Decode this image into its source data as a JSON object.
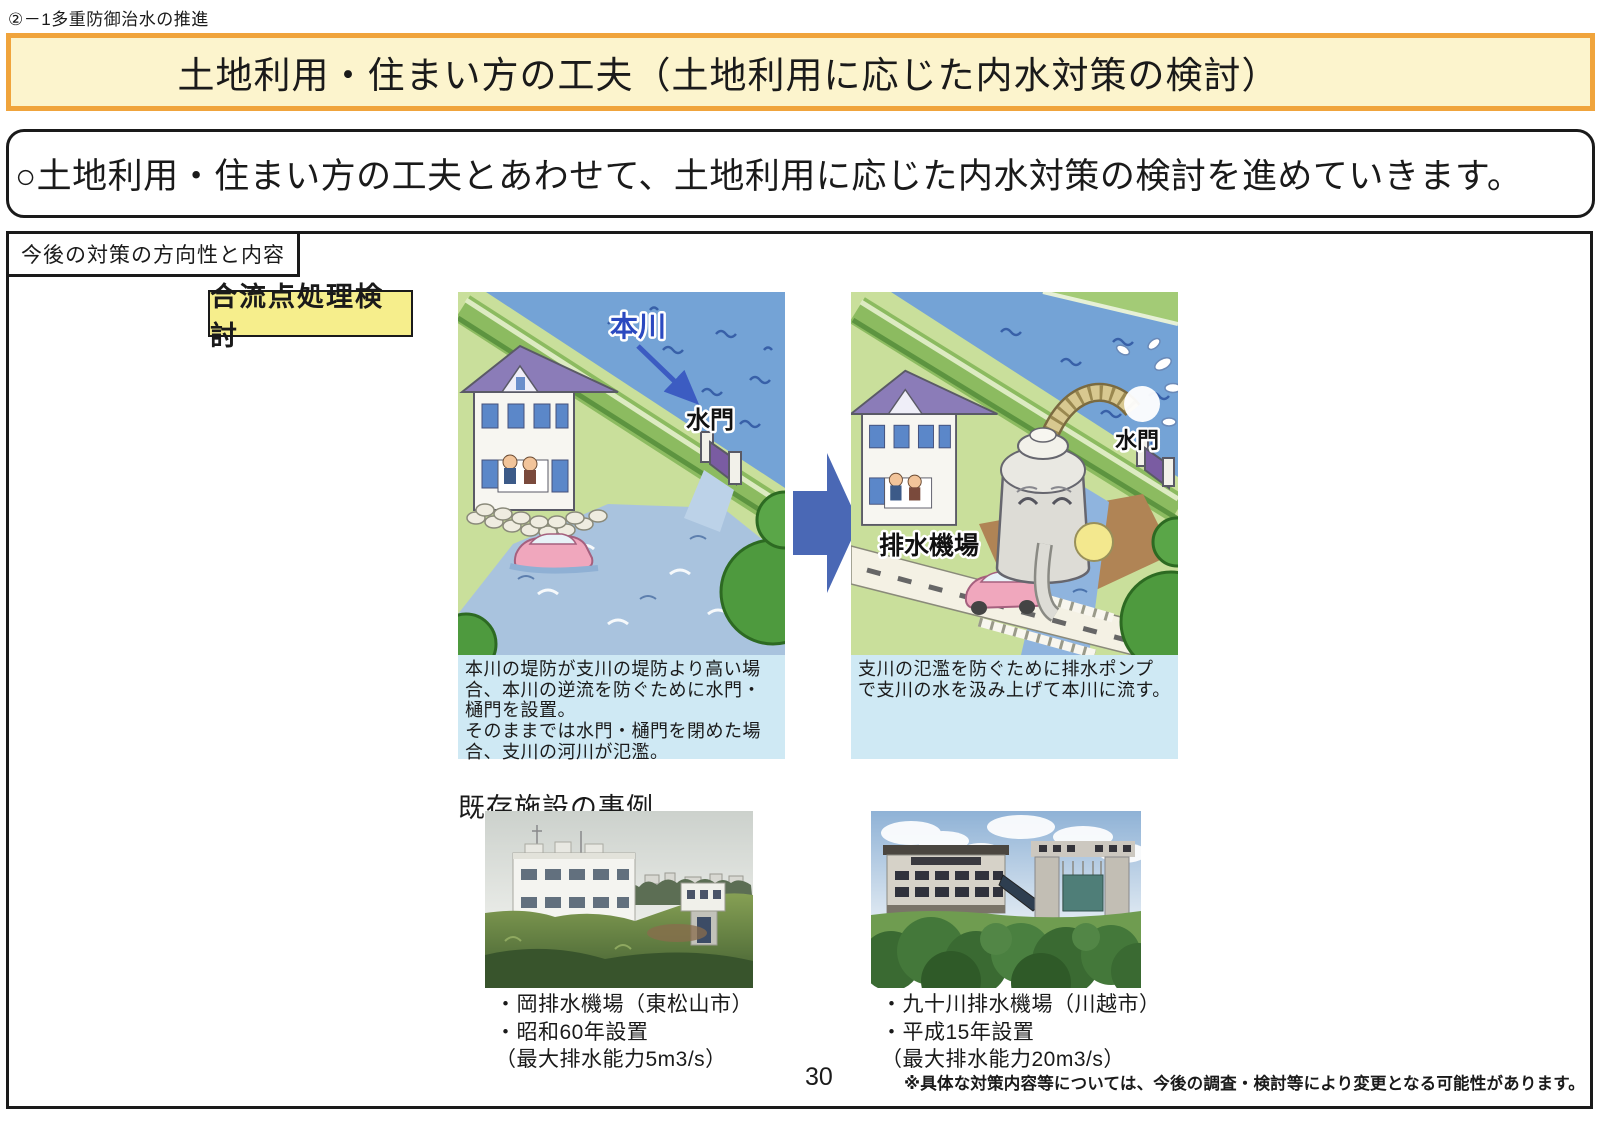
{
  "page": {
    "header_note": "②－1多重防御治水の推進",
    "title": "土地利用・住まい方の工夫（土地利用に応じた内水対策の検討）",
    "statement": "○土地利用・住まい方の工夫とあわせて、土地利用に応じた内水対策の検討を進めていきます。",
    "page_number": "30",
    "footer_note": "※具体な対策内容等については、今後の調査・検討等により変更となる可能性があります。"
  },
  "section": {
    "label": "今後の対策の方向性と内容",
    "tag": "合流点処理検討",
    "examples_heading": "既存施設の事例"
  },
  "figures": {
    "before": {
      "river_label": "本川",
      "gate_label": "水門",
      "caption": "本川の堤防が支川の堤防より高い場合、本川の逆流を防ぐために水門・樋門を設置。\nそのままでは水門・樋門を閉めた場合、支川の河川が氾濫。"
    },
    "after": {
      "pump_label": "排水機場",
      "gate_label": "水門",
      "caption": "支川の氾濫を防ぐために排水ポンプで支川の水を汲み上げて本川に流す。"
    }
  },
  "photos": [
    {
      "caption_lines": [
        "・岡排水機場（東松山市）",
        "・昭和60年設置",
        "（最大排水能力5m3/s）"
      ]
    },
    {
      "caption_lines": [
        "・九十川排水機場（川越市）",
        "・平成15年設置",
        "（最大排水能力20m3/s）"
      ]
    }
  ],
  "colors": {
    "banner_border": "#f0a43c",
    "banner_bg": "#fcf4cd",
    "tag_bg": "#f6ee8c",
    "caption_bg": "#cfe9f4",
    "arrow_blue": "#4a68b5",
    "river_blue": "#74a3d6",
    "river_label_blue": "#2b49c0"
  }
}
